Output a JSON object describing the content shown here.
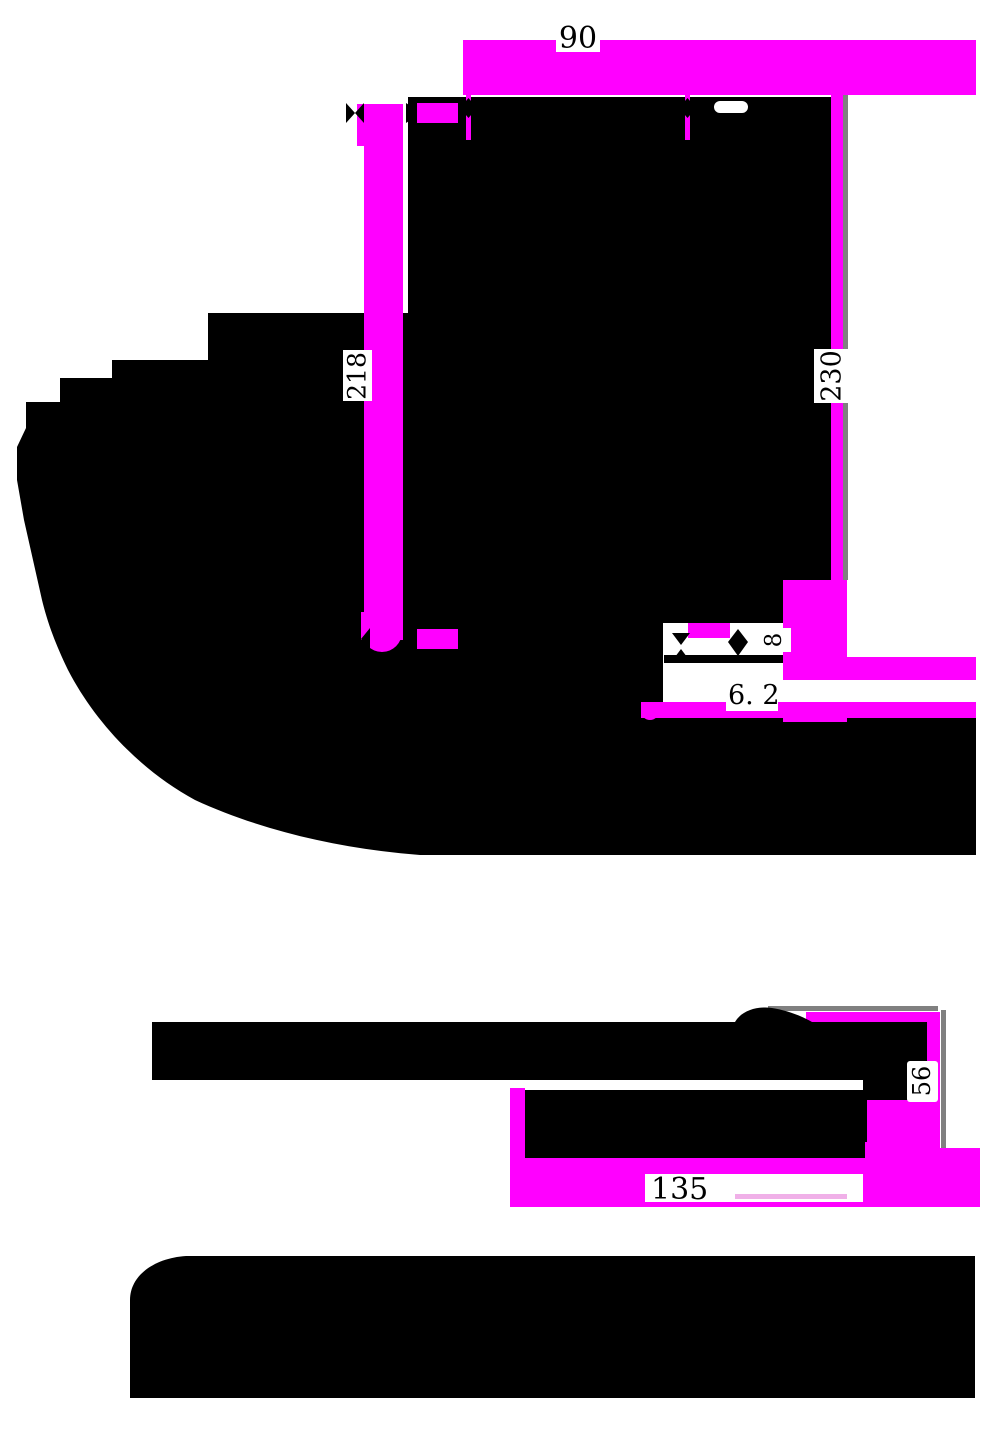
{
  "drawing": {
    "title": "Bracket engineering drawing with magenta-highlighted dimension entities",
    "colors": {
      "highlight": "#ff00ff",
      "ink": "#000000",
      "background": "#ffffff",
      "guide_gray": "#808080",
      "pale_highlight": "#f0b0e8"
    },
    "dimensions": {
      "front_top_width": {
        "label": "90"
      },
      "front_left_height": {
        "label": "218"
      },
      "front_right_height": {
        "label": "230"
      },
      "front_lip_gap": {
        "label": "8"
      },
      "front_slot_gap": {
        "label": "6. 2"
      },
      "side_height": {
        "label": "56"
      },
      "side_width": {
        "label": "135"
      }
    }
  }
}
